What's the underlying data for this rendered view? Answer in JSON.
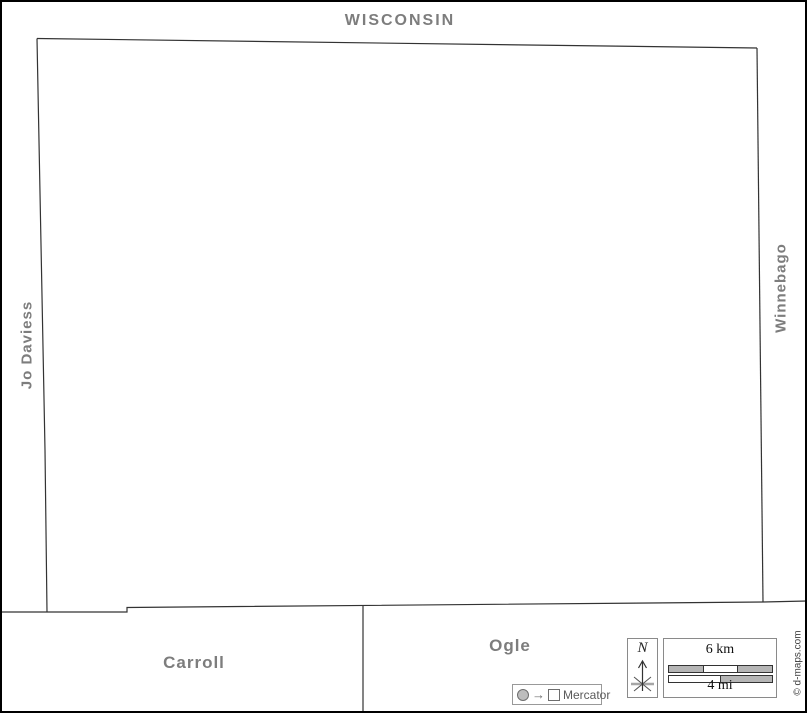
{
  "map": {
    "labels": {
      "north_state": "WISCONSIN",
      "west_county": "Jo Daviess",
      "east_county": "Winnebago",
      "southwest_county": "Carroll",
      "southeast_county": "Ogle"
    },
    "credit": "© d-maps.com",
    "compass": {
      "north": "N"
    },
    "scale": {
      "km_label": "6 km",
      "mi_label": "4 mi"
    },
    "projection": {
      "arrow": "→",
      "name": "Mercator"
    },
    "colors": {
      "label_gray": "#7d7d7d",
      "boundary_line": "#333333",
      "frame": "#000000",
      "scale_fill_gray": "#b5b5b5",
      "background": "#ffffff"
    }
  }
}
